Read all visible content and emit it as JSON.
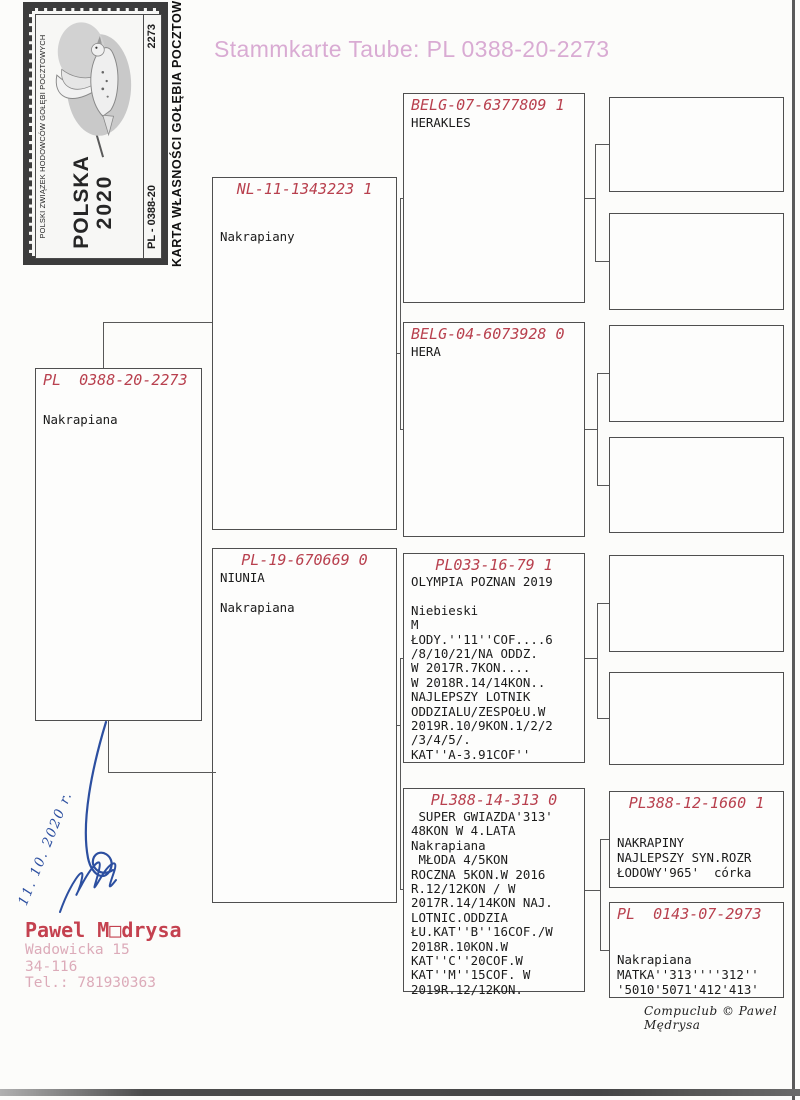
{
  "title": "Stammkarte Taube: PL  0388-20-2273",
  "stamp": {
    "org": "POLSKI ZWIĄZEK HODOWCÓW GOŁĘBI POCZTOWYCH",
    "country": "POLSKA",
    "year": "2020",
    "ring_series": "PL - 0388-20",
    "serial": "2273",
    "ownership_card_label": "KARTA WŁASNOŚCI GOŁĘBIA POCZTOWEGO"
  },
  "pedigree": {
    "subject": {
      "ring": "PL  0388-20-2273",
      "text": "Nakrapiana"
    },
    "father": {
      "ring": "NL-11-1343223 1",
      "text": "Nakrapiany"
    },
    "mother": {
      "ring": "PL-19-670669 0",
      "text": "NIUNIA\n\nNakrapiana"
    },
    "ff": {
      "ring": "BELG-07-6377809 1",
      "text": "HERAKLES"
    },
    "fm": {
      "ring": "BELG-04-6073928 0",
      "text": "HERA"
    },
    "mf": {
      "ring": "PL033-16-79 1",
      "text": "OLYMPIA POZNAN 2019\n\nNiebieski\nM\nŁODY.''11''COF....6\n/8/10/21/NA ODDZ.\nW 2017R.7KON....\nW 2018R.14/14KON..\nNAJLEPSZY LOTNIK\nODDZIALU/ZESPOŁU.W\n2019R.10/9KON.1/2/2\n/3/4/5/.\nKAT''A-3.91COF''"
    },
    "mm": {
      "ring": "PL388-14-313 0",
      "text": " SUPER GWIAZDA'313'\n48KON W 4.LATA\nNakrapiana\n MŁODA 4/5KON\nROCZNA 5KON.W 2016\nR.12/12KON / W\n2017R.14/14KON NAJ.\nLOTNIC.ODDZIA\nŁU.KAT''B''16COF./W\n2018R.10KON.W\nKAT''C''20COF.W\nKAT''M''15COF. W\n2019R.12/12KON."
    },
    "mmf": {
      "ring": "PL388-12-1660 1",
      "text": "NAKRAPINY\nNAJLEPSZY SYN.ROZR\nŁODOWY'965'  córka"
    },
    "mmm": {
      "ring": "PL  0143-07-2973",
      "text": "Nakrapiana\nMATKA''313''''312''\n'5010'5071'412'413'"
    }
  },
  "owner": {
    "name": "Pawel M□drysa",
    "street": "Wadowicka 15",
    "postal": "34-116",
    "phone": "Tel.: 781930363"
  },
  "handwriting": {
    "date": "11. 10. 2020 r."
  },
  "footer": {
    "credit": "Compuclub © Pawel Mędrysa"
  }
}
